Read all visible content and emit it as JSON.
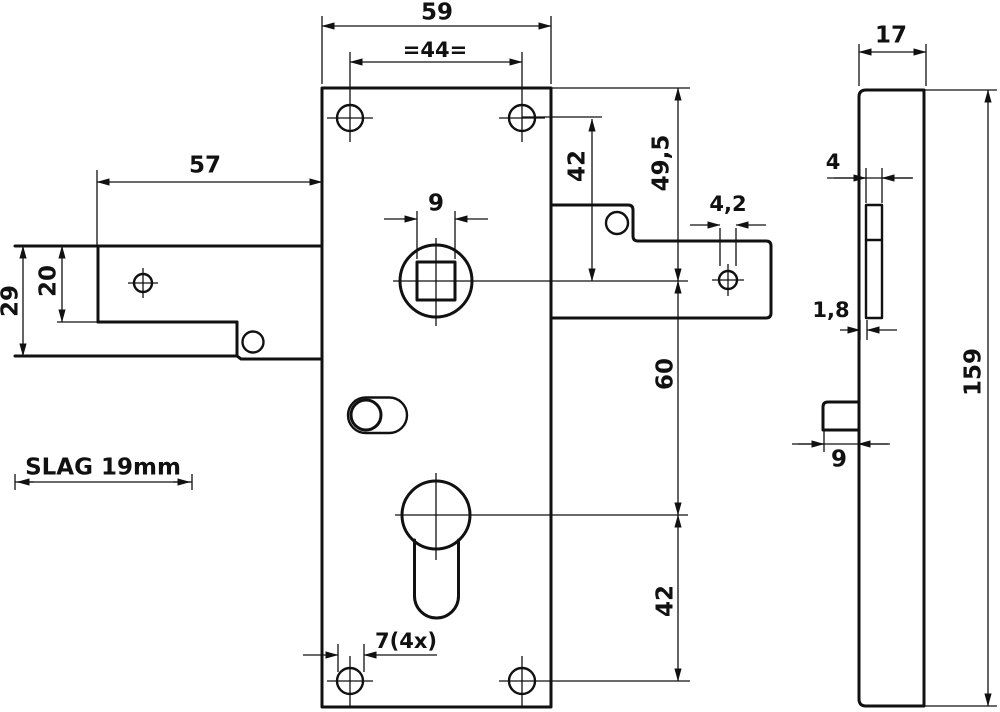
{
  "colors": {
    "ink": "#111111",
    "paper": "#ffffff"
  },
  "front_view": {
    "dim_width": "59",
    "dim_hole_spacing": "=44=",
    "dim_square_follower": "9",
    "dim_screw_holes": "7(4x)",
    "dim_top_to_center": "49,5",
    "dim_screw_to_center": "42",
    "dim_center_to_cylinder": "60",
    "dim_cylinder_to_screw": "42"
  },
  "bolt_detail": {
    "dim_length": "57",
    "dim_tail_height": "20",
    "dim_head_height": "29",
    "throw_label": "SLAG 19mm"
  },
  "strike_tab": {
    "dim_hole": "4,2"
  },
  "side_view": {
    "dim_depth": "17",
    "dim_slot_width": "4",
    "dim_plate_thickness": "1,8",
    "dim_bolt_width": "9",
    "dim_height": "159"
  }
}
